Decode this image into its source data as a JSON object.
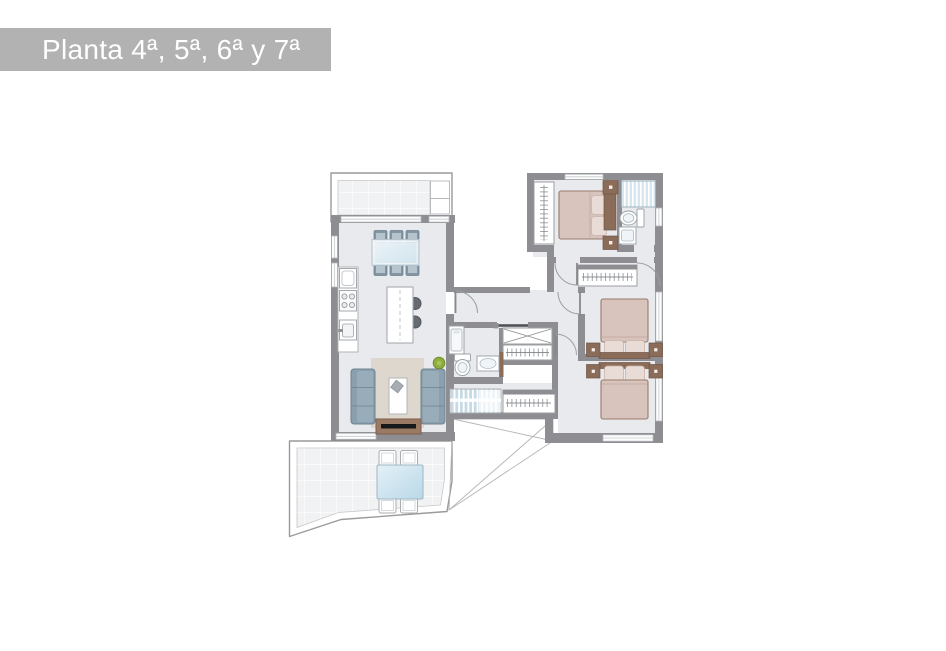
{
  "title": {
    "text": "Planta 4ª, 5ª, 6ª y 7ª"
  },
  "palette": {
    "banner_bg": "#b2b2b2",
    "banner_text": "#ffffff",
    "wall": "#8e8e92",
    "floor": "#e9eaed",
    "tile_bg": "#f1f2f3",
    "outline": "#9a9a9a",
    "wood": "#8a6c59",
    "bed": "#d8c3bd",
    "bed_edge": "#977b6c",
    "pillow": "#e9dcd7",
    "sofa": "#8ba0af",
    "sofa_edge": "#6d8290",
    "rug": "#ddd7cd",
    "glass_blue": "#cfe3ee",
    "shower_blue": "#d7e6ef",
    "stairs_blue": "#c6d9e5",
    "plant_green": "#8fae3e",
    "tv_black": "#17181a"
  }
}
